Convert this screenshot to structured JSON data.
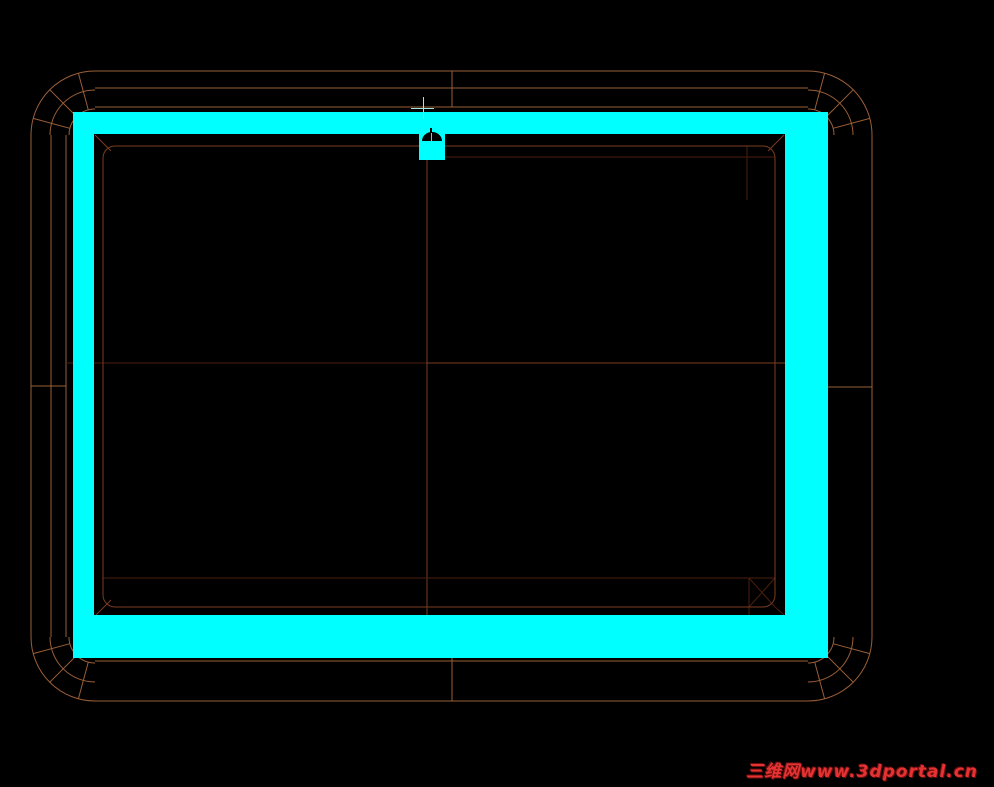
{
  "app": {
    "type": "cad-wireframe-viewport",
    "background": "#000000"
  },
  "watermark": {
    "text": "三维网www.3dportal.cn",
    "color": "#e53232",
    "shadow": "#6e0f0f"
  },
  "drawing": {
    "canvas": {
      "w": 994,
      "h": 787,
      "bg": "#000000"
    },
    "colors": {
      "bright": "#9a5f37",
      "mid": "#7a3c20",
      "dim": "#4a1e0d",
      "highlight": "#00ffff",
      "hole": "#000000",
      "crosshair": "#9fe6e6"
    },
    "selection_frame": {
      "bands": {
        "top": {
          "x": 73,
          "y": 112,
          "w": 755,
          "h": 22
        },
        "left": {
          "x": 73,
          "y": 112,
          "w": 21,
          "h": 546
        },
        "right": {
          "x": 785,
          "y": 112,
          "w": 43,
          "h": 546
        },
        "bottom": {
          "x": 73,
          "y": 615,
          "w": 755,
          "h": 43
        }
      }
    },
    "camera_marker": {
      "body": {
        "x": 419,
        "y": 134,
        "w": 26,
        "h": 26
      },
      "hole": {
        "x": 422,
        "y": 132,
        "w": 20,
        "h": 9
      },
      "slit": {
        "x": 431,
        "y": 133,
        "w": 1,
        "h": 8
      },
      "tick": {
        "x": 430,
        "y": 128,
        "w": 2,
        "h": 5
      }
    },
    "crosshair": {
      "h": {
        "x": 411,
        "y": 108,
        "w": 23,
        "h": 1
      },
      "v": {
        "x": 423,
        "y": 97,
        "w": 1,
        "h": 22
      }
    },
    "wireframe": {
      "lines": [
        {
          "x1": 95,
          "y1": 71,
          "x2": 808,
          "y2": 71,
          "c": "bright"
        },
        {
          "x1": 95,
          "y1": 88,
          "x2": 808,
          "y2": 88,
          "c": "bright"
        },
        {
          "x1": 95,
          "y1": 107,
          "x2": 808,
          "y2": 107,
          "c": "bright"
        },
        {
          "x1": 31,
          "y1": 135,
          "x2": 31,
          "y2": 637,
          "c": "bright"
        },
        {
          "x1": 51,
          "y1": 135,
          "x2": 51,
          "y2": 637,
          "c": "bright"
        },
        {
          "x1": 66,
          "y1": 135,
          "x2": 66,
          "y2": 637,
          "c": "bright"
        },
        {
          "x1": 872,
          "y1": 135,
          "x2": 872,
          "y2": 637,
          "c": "bright"
        },
        {
          "x1": 95,
          "y1": 661,
          "x2": 808,
          "y2": 661,
          "c": "bright"
        },
        {
          "x1": 95,
          "y1": 701,
          "x2": 808,
          "y2": 701,
          "c": "bright"
        },
        {
          "x1": 452,
          "y1": 71,
          "x2": 452,
          "y2": 107,
          "c": "bright"
        },
        {
          "x1": 452,
          "y1": 658,
          "x2": 452,
          "y2": 701,
          "c": "bright"
        },
        {
          "x1": 31,
          "y1": 386,
          "x2": 66,
          "y2": 386,
          "c": "bright"
        },
        {
          "x1": 828,
          "y1": 387,
          "x2": 872,
          "y2": 387,
          "c": "bright"
        },
        {
          "x1": 66,
          "y1": 363,
          "x2": 427,
          "y2": 363,
          "c": "dim"
        },
        {
          "x1": 427,
          "y1": 363,
          "x2": 785,
          "y2": 363,
          "c": "mid"
        },
        {
          "x1": 427,
          "y1": 160,
          "x2": 427,
          "y2": 615,
          "c": "mid"
        },
        {
          "x1": 445,
          "y1": 157,
          "x2": 775,
          "y2": 157,
          "c": "dim"
        },
        {
          "x1": 103,
          "y1": 578,
          "x2": 775,
          "y2": 578,
          "c": "dim"
        },
        {
          "x1": 747,
          "y1": 146,
          "x2": 747,
          "y2": 200,
          "c": "dim"
        },
        {
          "x1": 749,
          "y1": 578,
          "x2": 749,
          "y2": 615,
          "c": "dim"
        },
        {
          "x1": 749,
          "y1": 578,
          "x2": 775,
          "y2": 607,
          "c": "dim"
        },
        {
          "x1": 775,
          "y1": 578,
          "x2": 749,
          "y2": 607,
          "c": "dim"
        },
        {
          "x1": 775,
          "y1": 607,
          "x2": 784,
          "y2": 615,
          "c": "dim"
        },
        {
          "x1": 95,
          "y1": 135,
          "x2": 111,
          "y2": 151,
          "c": "mid"
        },
        {
          "x1": 784,
          "y1": 135,
          "x2": 768,
          "y2": 151,
          "c": "mid"
        },
        {
          "x1": 95,
          "y1": 616,
          "x2": 111,
          "y2": 600,
          "c": "mid"
        },
        {
          "x1": 69.9,
          "y1": 128.3,
          "x2": 33.2,
          "y2": 118.4,
          "c": "bright"
        },
        {
          "x1": 76.6,
          "y1": 116.6,
          "x2": 49.7,
          "y2": 89.7,
          "c": "bright"
        },
        {
          "x1": 88.3,
          "y1": 109.9,
          "x2": 78.4,
          "y2": 73.2,
          "c": "bright"
        },
        {
          "x1": 814.7,
          "y1": 109.9,
          "x2": 824.6,
          "y2": 73.2,
          "c": "bright"
        },
        {
          "x1": 826.4,
          "y1": 116.6,
          "x2": 853.3,
          "y2": 89.7,
          "c": "bright"
        },
        {
          "x1": 833.1,
          "y1": 128.3,
          "x2": 869.8,
          "y2": 118.4,
          "c": "bright"
        },
        {
          "x1": 833.1,
          "y1": 643.7,
          "x2": 869.8,
          "y2": 653.6,
          "c": "bright"
        },
        {
          "x1": 826.4,
          "y1": 655.4,
          "x2": 853.3,
          "y2": 682.3,
          "c": "bright"
        },
        {
          "x1": 814.7,
          "y1": 662.1,
          "x2": 824.6,
          "y2": 698.8,
          "c": "bright"
        },
        {
          "x1": 88.3,
          "y1": 662.1,
          "x2": 78.4,
          "y2": 698.8,
          "c": "bright"
        },
        {
          "x1": 76.6,
          "y1": 655.4,
          "x2": 49.7,
          "y2": 682.3,
          "c": "bright"
        },
        {
          "x1": 69.9,
          "y1": 643.7,
          "x2": 33.2,
          "y2": 653.6,
          "c": "bright"
        }
      ],
      "arcs": [
        {
          "d": "M 31 135 A 64 64 0 0 1 95 71",
          "c": "bright"
        },
        {
          "d": "M 50 135 A 45 45 0 0 1 95 90",
          "c": "bright"
        },
        {
          "d": "M 69 135 A 26 26 0 0 1 95 109",
          "c": "bright"
        },
        {
          "d": "M 808 71 A 64 64 0 0 1 872 135",
          "c": "bright"
        },
        {
          "d": "M 808 90 A 45 45 0 0 1 853 135",
          "c": "bright"
        },
        {
          "d": "M 808 109 A 26 26 0 0 1 834 135",
          "c": "bright"
        },
        {
          "d": "M 872 637 A 64 64 0 0 1 808 701",
          "c": "bright"
        },
        {
          "d": "M 853 637 A 45 45 0 0 1 808 682",
          "c": "bright"
        },
        {
          "d": "M 834 637 A 26 26 0 0 1 808 663",
          "c": "bright"
        },
        {
          "d": "M 95 701 A 64 64 0 0 1 31 637",
          "c": "bright"
        },
        {
          "d": "M 95 682 A 45 45 0 0 1 50 637",
          "c": "bright"
        },
        {
          "d": "M 95 663 A 26 26 0 0 1 69 637",
          "c": "bright"
        }
      ],
      "rects": [
        {
          "x": 103,
          "y": 146,
          "w": 672,
          "h": 461,
          "rx": 12,
          "c": "mid"
        }
      ]
    }
  }
}
